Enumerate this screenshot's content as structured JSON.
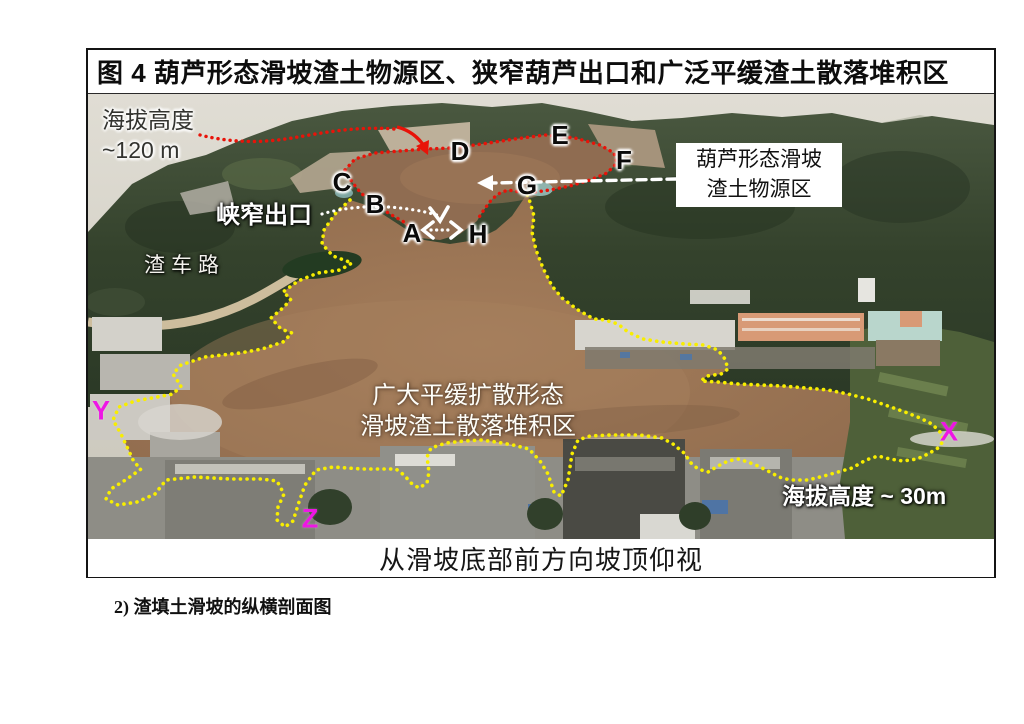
{
  "figure": {
    "title": "图 4 葫芦形态滑坡渣土物源区、狭窄葫芦出口和广泛平缓渣土散落堆积区",
    "view_caption": "从滑坡底部前方向坡顶仰视"
  },
  "photo": {
    "labels": {
      "elevation_top_line1": "海拔高度",
      "elevation_top_line2": "~120 m",
      "narrow_outlet": "峡窄出口",
      "truck_road": "渣车路",
      "source_zone_line1": "葫芦形态滑坡",
      "source_zone_line2": "渣土物源区",
      "deposit_zone_line1": "广大平缓扩散形态",
      "deposit_zone_line2": "滑坡渣土散落堆积区",
      "elevation_bottom": "海拔高度 ~ 30m"
    },
    "point_markers": {
      "A": "A",
      "B": "B",
      "C": "C",
      "D": "D",
      "E": "E",
      "F": "F",
      "G": "G",
      "H": "H"
    },
    "section_markers": {
      "X": "X",
      "Y": "Y",
      "Z": "Z"
    }
  },
  "below_figure": {
    "subsection_label": "2) 渣填土滑坡的纵横剖面图"
  },
  "colors": {
    "outline_red": "#e81309",
    "boundary_yellow": "#f8ee00",
    "marker_magenta": "#ee16e4",
    "annotation_white": "#ffffff"
  }
}
